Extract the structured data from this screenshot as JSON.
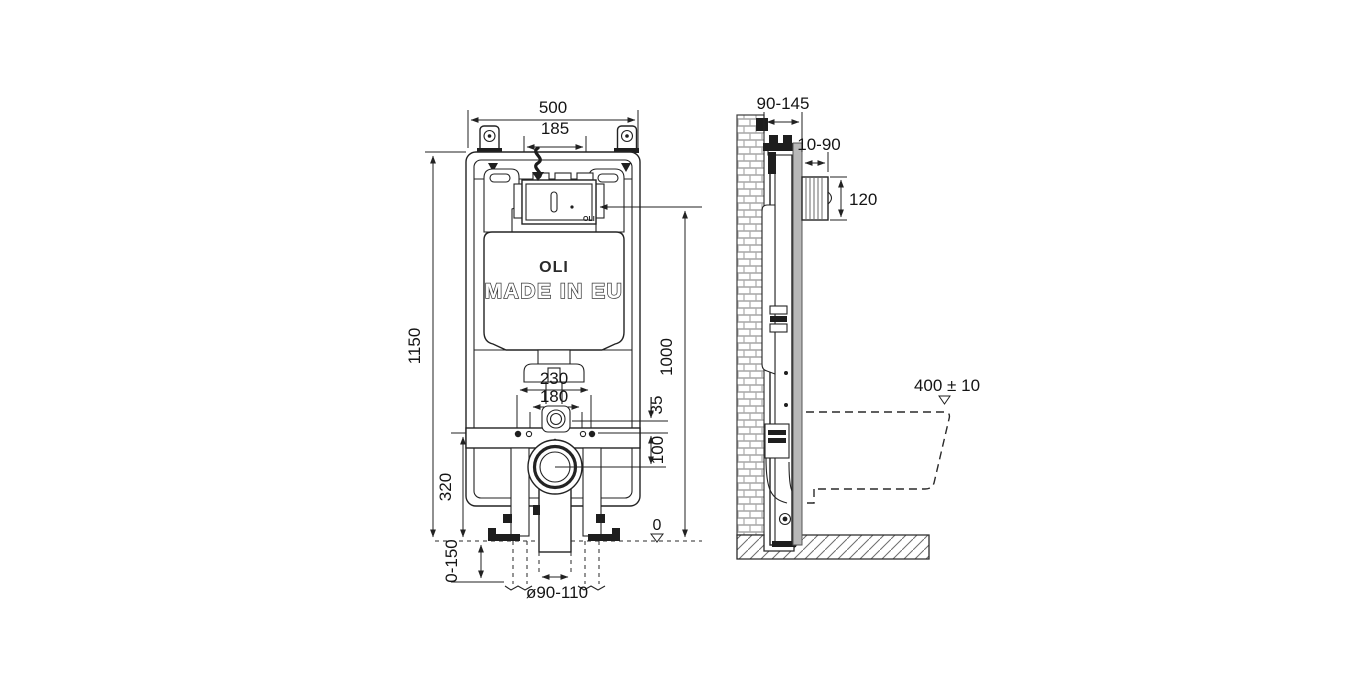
{
  "front_view": {
    "dimensions": {
      "overall_width": "500",
      "flush_plate_spacing": "185",
      "overall_height": "1150",
      "flush_plate_center_height": "1000",
      "fixing_bolt_spacing": "230",
      "water_supply_spacing": "180",
      "inlet_offset": "35",
      "outlet_offset": "100",
      "fixing_bar_height": "320",
      "floor_level": "0",
      "leg_adjustment": "0-150",
      "outlet_diameter": "ø90-110"
    },
    "branding": {
      "logo": "OLI",
      "origin": "MADE IN EU",
      "plate_logo": "OLI"
    }
  },
  "side_view": {
    "dimensions": {
      "frame_depth": "90-145",
      "wall_finish_depth": "10-90",
      "inspection_box_height": "120",
      "bowl_height_tolerance": "400 ± 10"
    }
  }
}
